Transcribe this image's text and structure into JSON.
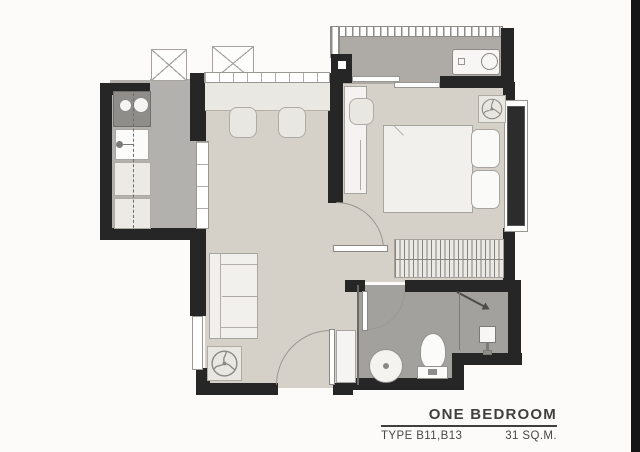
{
  "floorplan": {
    "title": "ONE BEDROOM",
    "type_label": "TYPE B11,B13",
    "area_label": "31 SQ.M.",
    "colors": {
      "wall": "#262626",
      "floor_living_bedroom": "#d5d0c8",
      "floor_kitchen": "#b3b1ad",
      "floor_balcony": "#aeaaa5",
      "floor_bathroom": "#a2a19e",
      "furniture_fill": "#f1f0ed",
      "furniture_stroke": "#a8a5a0",
      "window_glass": "#2c2c2c",
      "text": "#3f3f3f"
    },
    "symbols": [
      "ac-condenser-icon",
      "balcony-railing",
      "stove-icon",
      "sink-icon",
      "kitchen-counter",
      "dining-counter",
      "stool-icon",
      "sofa-icon",
      "fan-coil-icon",
      "bed-icon",
      "pillow-icon",
      "desk-icon",
      "wardrobe-icon",
      "washbasin-icon",
      "toilet-icon",
      "shower-icon",
      "door-swing",
      "window",
      "sliding-door"
    ]
  }
}
